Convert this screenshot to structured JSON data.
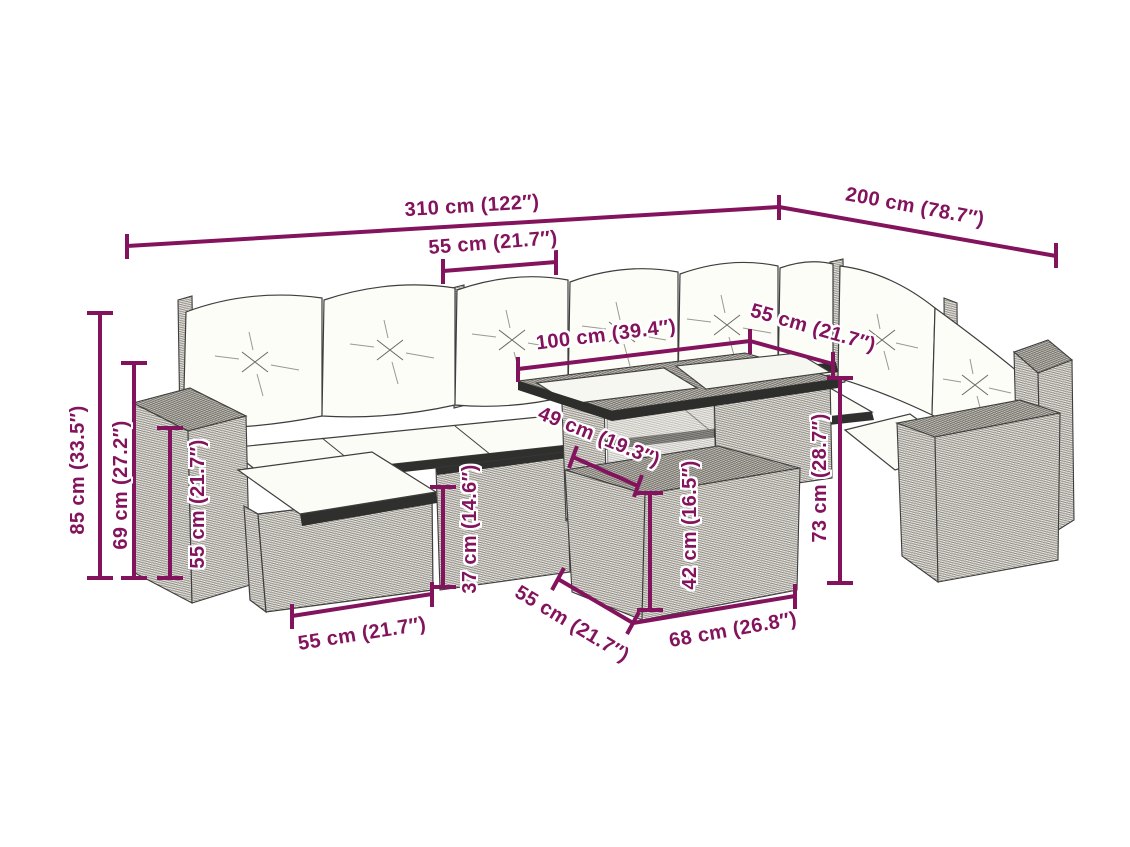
{
  "colors": {
    "dimension_color": "#83135C",
    "line_art_color": "#3E3E3E",
    "background": "#FFFFFF"
  },
  "dimensions": {
    "width_total": "310 cm (122″)",
    "depth_total": "200 cm (78.7″)",
    "seat_width_top": "55 cm (21.7″)",
    "table_top_length": "100 cm (39.4″)",
    "table_top_width": "55 cm (21.7″)",
    "height_total": "85 cm (33.5″)",
    "height_back": "69 cm (27.2″)",
    "height_armrest": "55 cm (21.7″)",
    "height_seat": "37 cm (14.6″)",
    "height_table": "42 cm (16.5″)",
    "clearance_under_table": "49 cm (19.3″)",
    "height_right_section": "73 cm (28.7″)",
    "footstool_width": "55 cm (21.7″)",
    "footstool_depth": "55 cm (21.7″)",
    "footstool_length": "68 cm (26.8″)"
  }
}
